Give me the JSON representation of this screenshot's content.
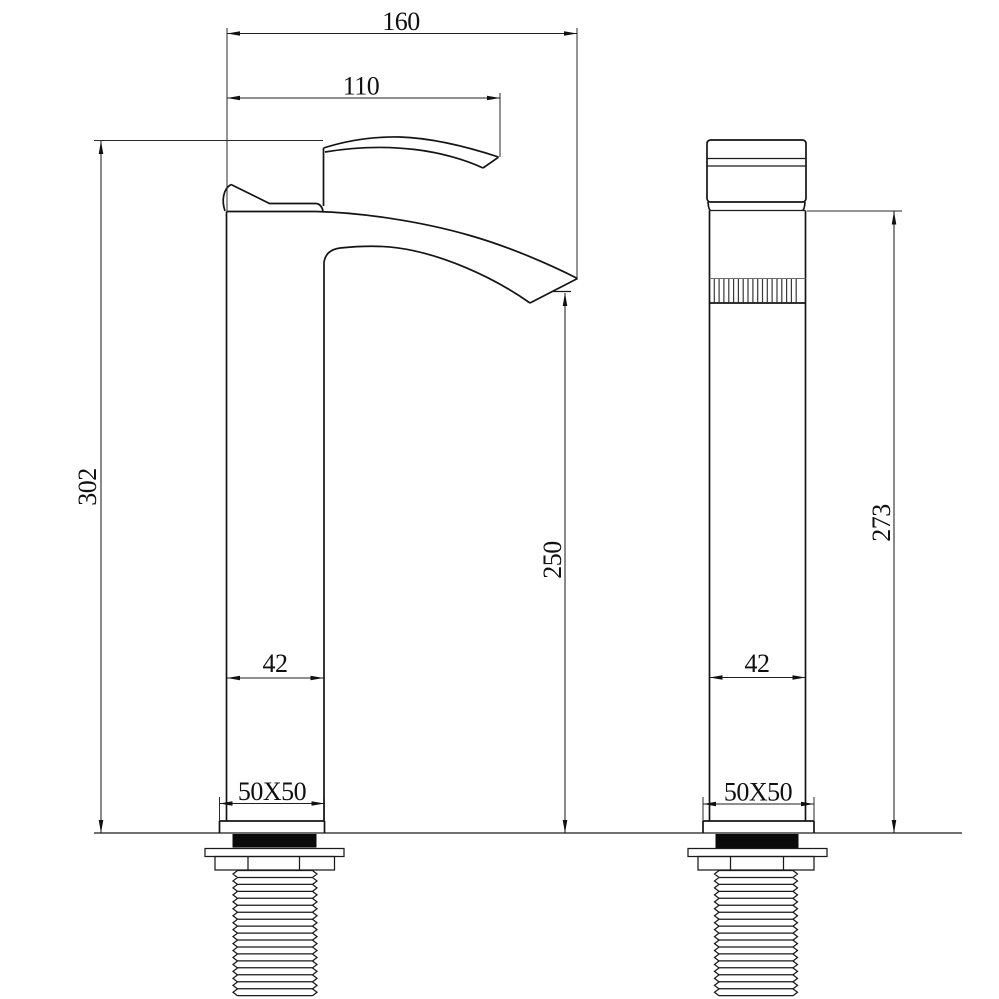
{
  "drawing": {
    "background": "#ffffff",
    "line_color": "#141414",
    "views": {
      "side": {
        "dims": {
          "reach_total": "160",
          "reach_spout": "110",
          "height_overall": "302",
          "height_outlet": "250",
          "body_depth": "42",
          "base_plate": "50X50"
        }
      },
      "front": {
        "dims": {
          "height_body": "273",
          "body_width": "42",
          "base_plate": "50X50"
        }
      }
    }
  }
}
